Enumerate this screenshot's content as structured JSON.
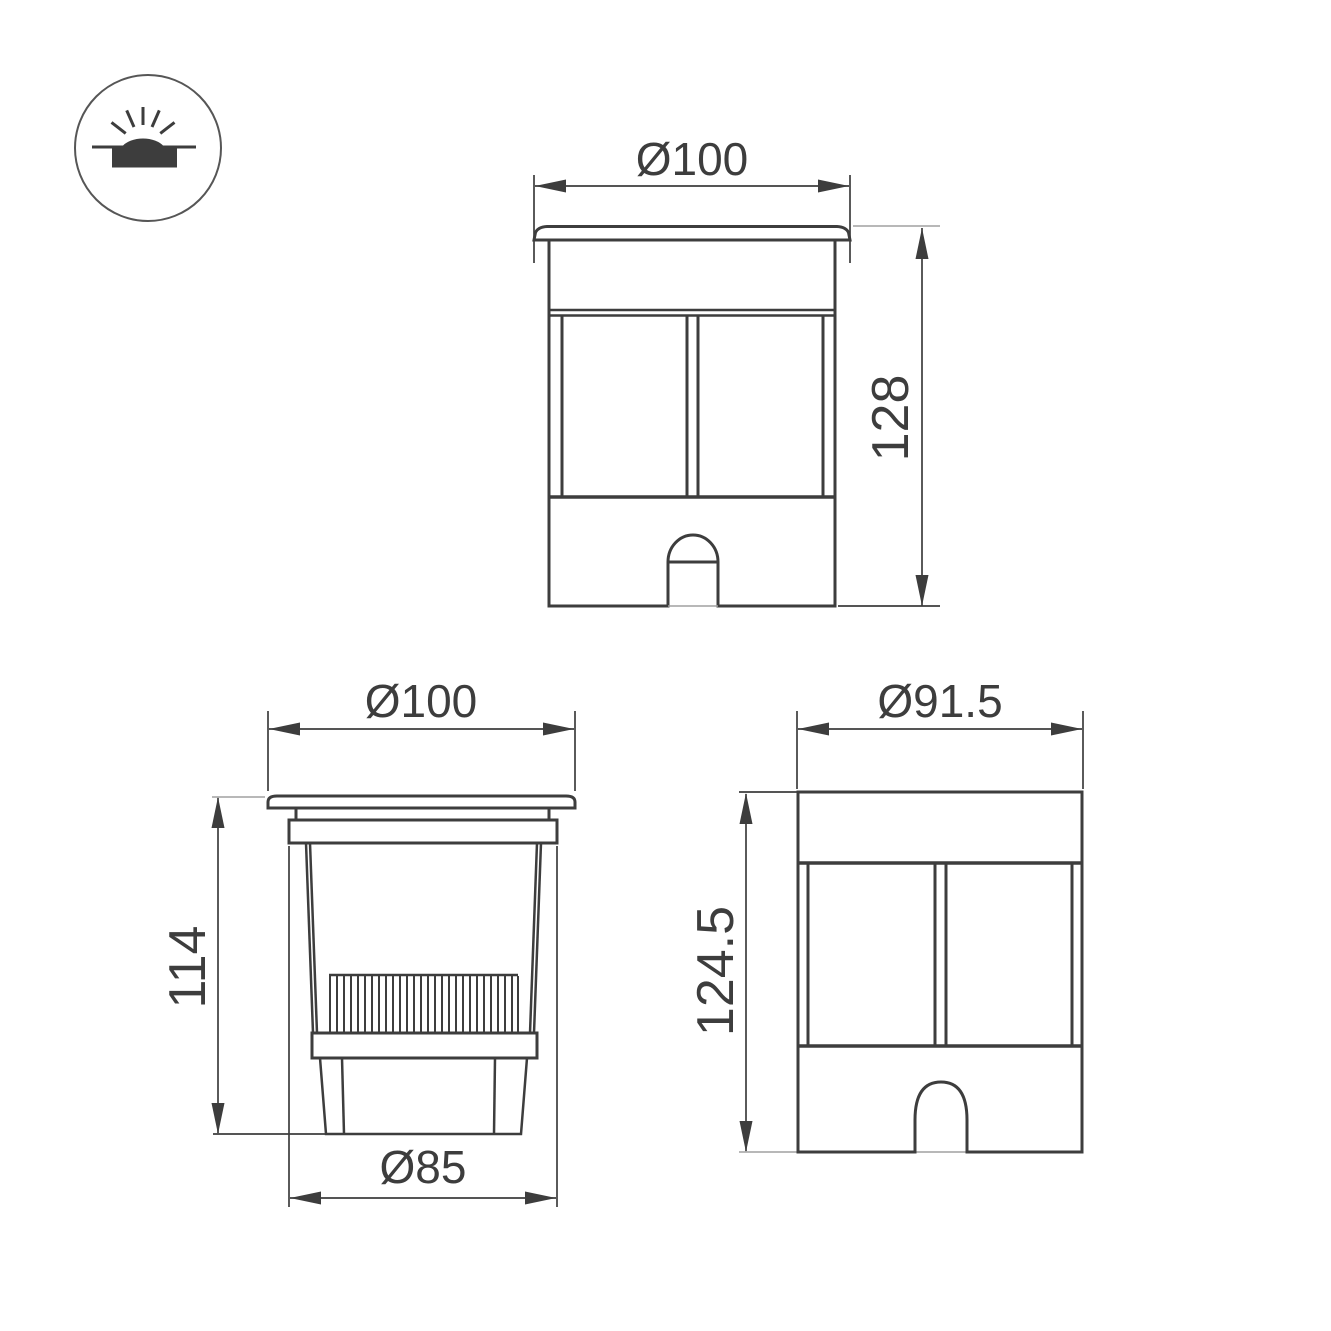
{
  "colors": {
    "line": "#3d3d3d",
    "ext": "#a0a0a0",
    "bg": "#ffffff"
  },
  "icon": {
    "name": "recessed-ground-luminaire-symbol"
  },
  "views": {
    "front": {
      "label_diameter": "Ø100",
      "label_height": "128"
    },
    "section": {
      "label_diameter": "Ø100",
      "label_height": "114",
      "label_base_diameter": "Ø85"
    },
    "housing": {
      "label_diameter": "Ø91.5",
      "label_height": "124.5"
    }
  }
}
